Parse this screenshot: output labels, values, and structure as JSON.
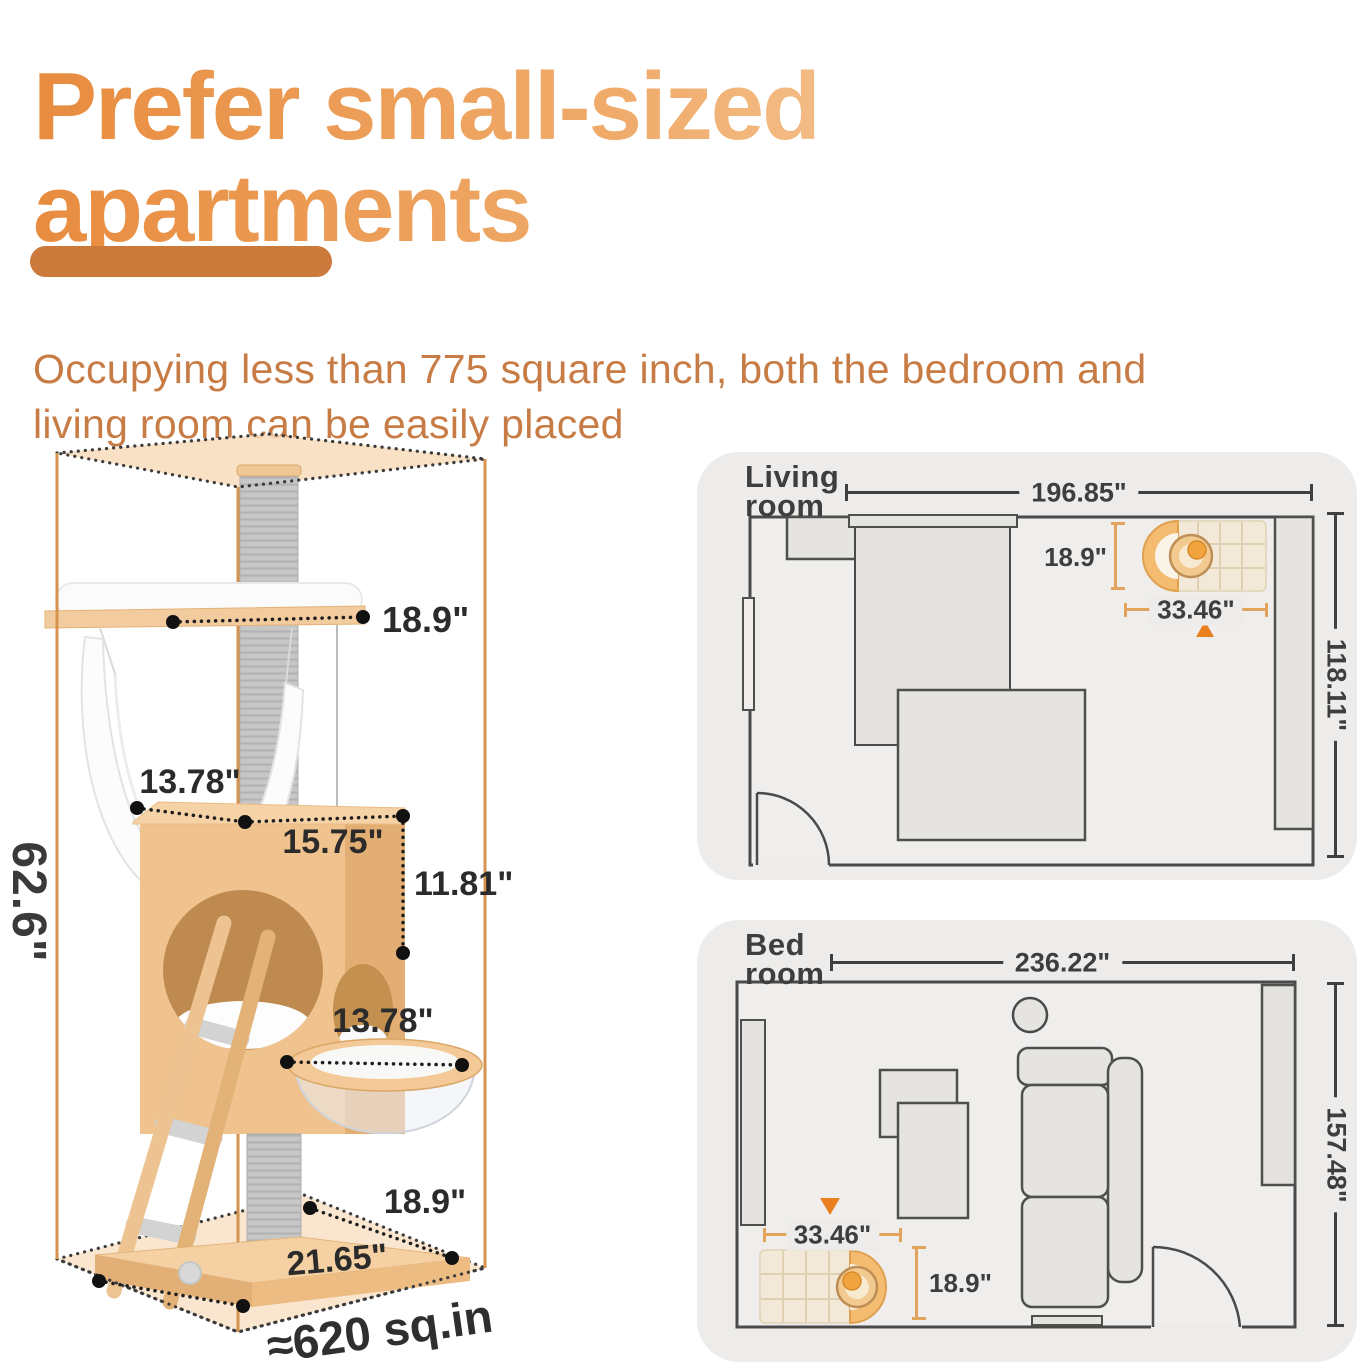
{
  "header": {
    "title": "Prefer small-sized apartments",
    "description": "Occupying less than 775 square inch, both the bedroom and living room can be easily placed"
  },
  "cat_tree": {
    "overall_height": "62.6\"",
    "footprint_area": "≈620 sq.in",
    "top_perch_width": "18.9\"",
    "condo_depth": "13.78\"",
    "condo_width": "15.75\"",
    "condo_height": "11.81\"",
    "capsule_diameter": "13.78\"",
    "base_depth": "18.9\"",
    "base_width": "21.65\""
  },
  "living_room": {
    "title": "Living room",
    "room_width": "196.85\"",
    "room_depth": "118.11\"",
    "tree_width": "33.46\"",
    "tree_depth": "18.9\""
  },
  "bedroom": {
    "title": "Bed room",
    "room_width": "236.22\"",
    "room_depth": "157.48\"",
    "tree_width": "33.46\"",
    "tree_depth": "18.9\""
  },
  "colors": {
    "title_gradient_start": "#E88C3F",
    "title_gradient_end": "#F7D5AB",
    "divider": "#CB7A3C",
    "body_text": "#C87C45",
    "box_line_orange": "#D6934F",
    "box_face_fill": "#F8DCBB",
    "dim_orange": "#E2A45C",
    "position_marker": "#E8801F",
    "panel_background": "#EDECEB",
    "plan_line": "#4A4A4A",
    "wood": "#F2CC9E",
    "post_gray": "#C7C7C7"
  }
}
